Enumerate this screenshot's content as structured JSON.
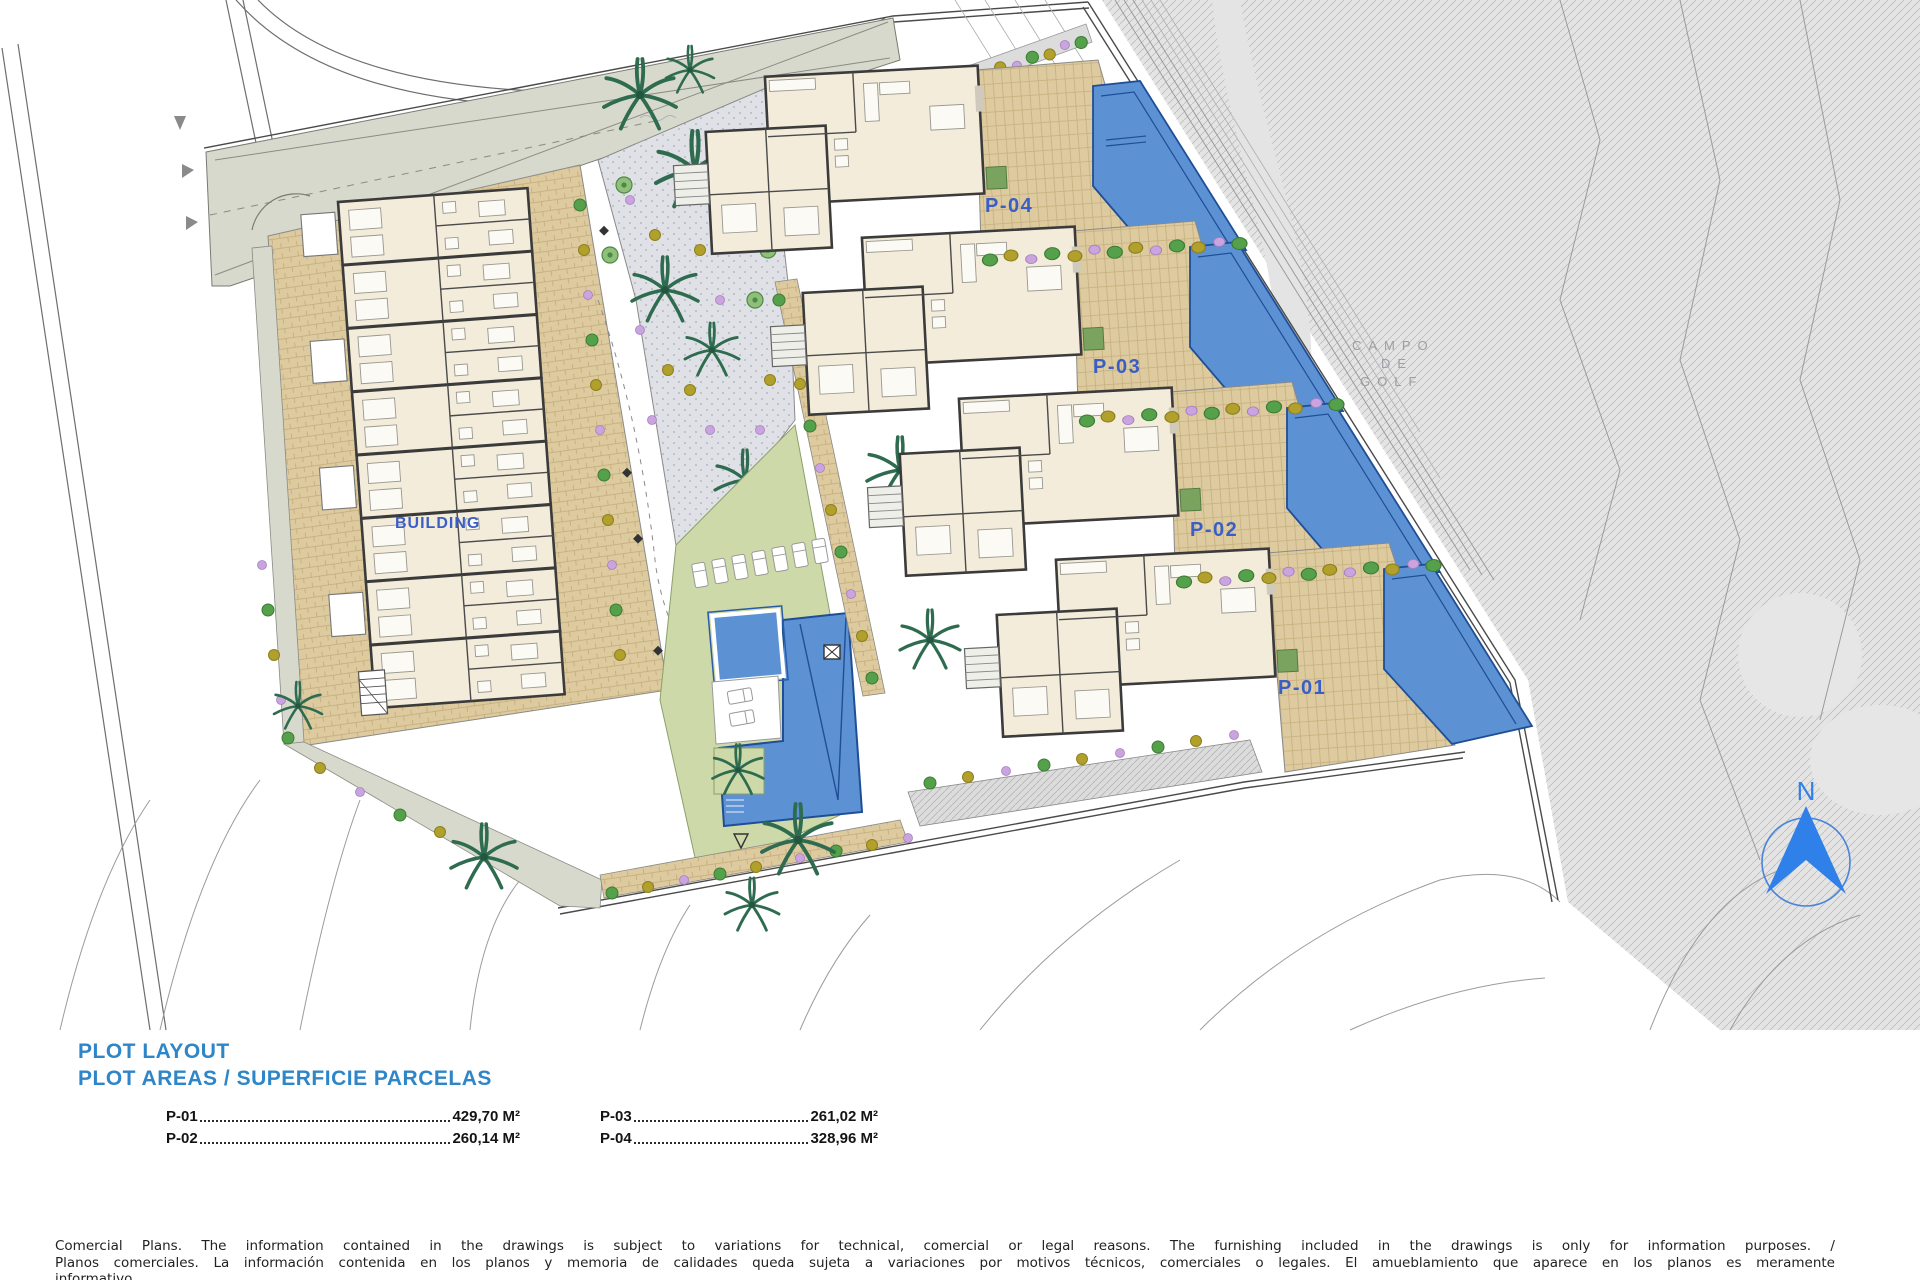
{
  "plan": {
    "building_label": "BUILDING",
    "plot_labels": {
      "p01": "P-01",
      "p02": "P-02",
      "p03": "P-03",
      "p04": "P-04"
    },
    "golf_label": {
      "line1": "CAMPO",
      "line2": "DE",
      "line3": "GOLF"
    },
    "north_label": "N"
  },
  "legend": {
    "title_line1": "PLOT LAYOUT",
    "title_line2": "PLOT AREAS / SUPERFICIE PARCELAS",
    "entries": [
      {
        "id": "P-01",
        "value": "429,70 M²"
      },
      {
        "id": "P-02",
        "value": "260,14 M²"
      },
      {
        "id": "P-03",
        "value": "261,02 M²"
      },
      {
        "id": "P-04",
        "value": "328,96 M²"
      }
    ]
  },
  "disclaimer": {
    "line1": "Comercial Plans. The information contained in the drawings is subject to variations for technical, comercial or legal reasons. The furnishing included in the drawings is only for information purposes. /",
    "line2": "Planos comerciales. La información contenida en los planos y memoria de calidades queda sujeta a variaciones por motivos técnicos, comerciales o legales. El amueblamiento que aparece en los planos es meramente",
    "line3": "informativo."
  },
  "colors": {
    "title_blue": "#2e86c9",
    "label_blue": "#3a5ec5",
    "pool_blue": "#5c92d3",
    "north_blue": "#2f80e8",
    "golf_text_gray": "#9aa0a6"
  }
}
